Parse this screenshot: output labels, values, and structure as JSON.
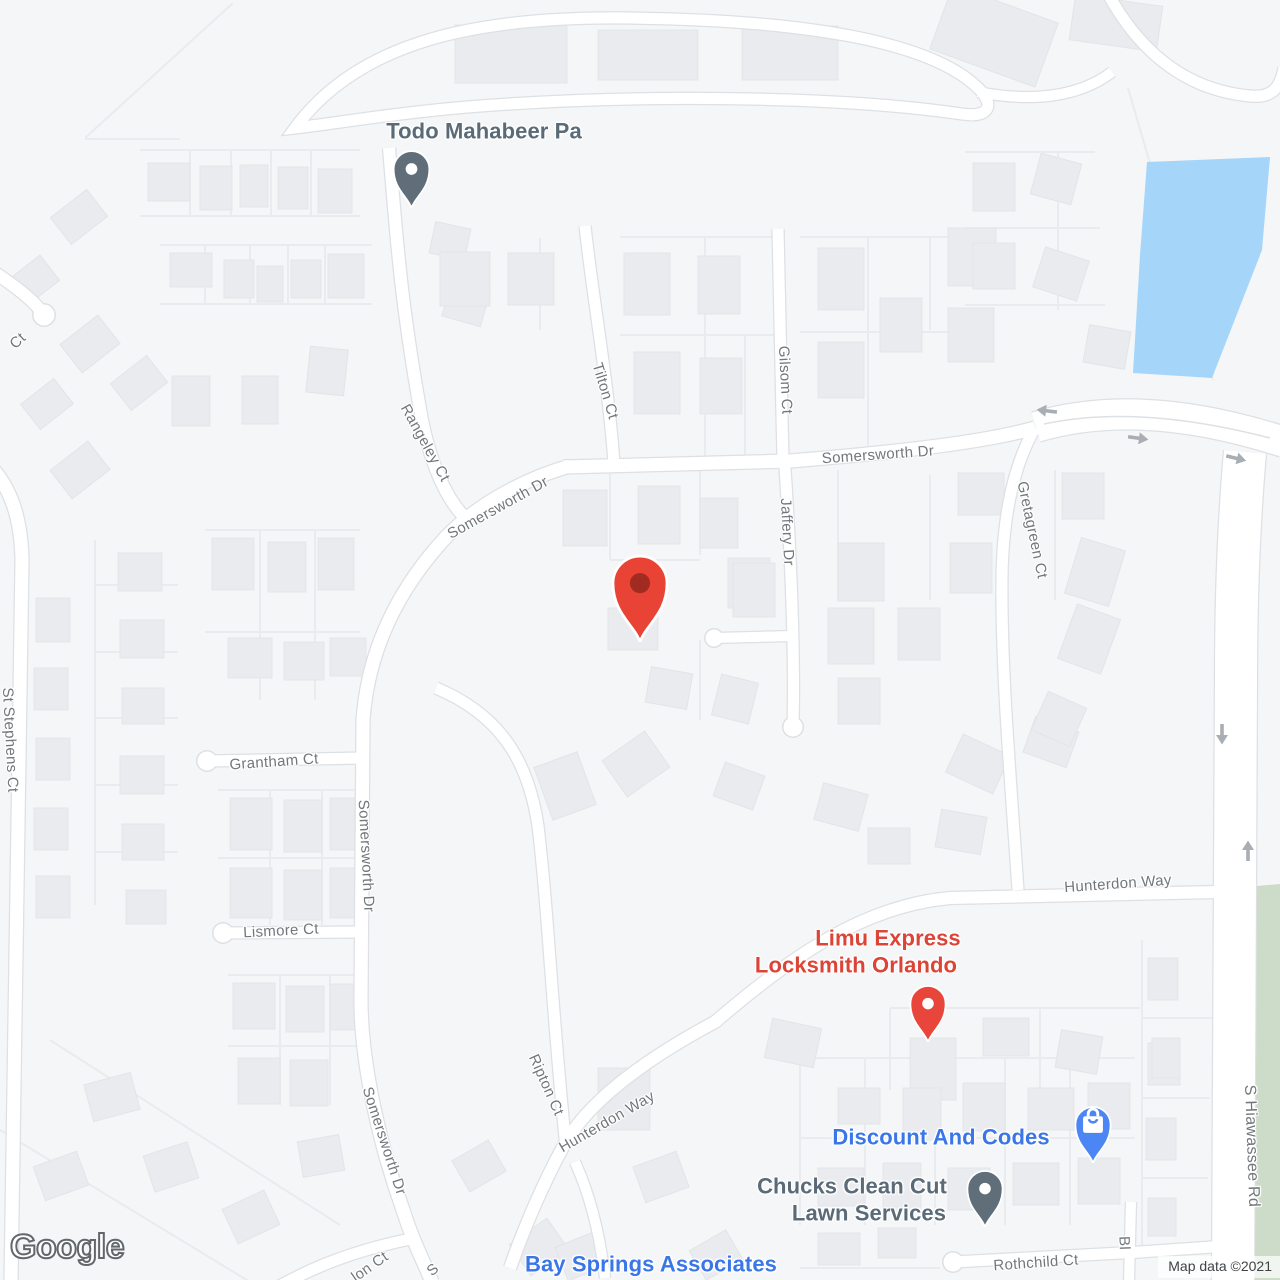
{
  "map": {
    "provider_logo": "Google",
    "attribution": "Map data ©2021",
    "colors": {
      "land": "#f5f6f7",
      "road_fill": "#ffffff",
      "road_casing": "#dde0e4",
      "parcel_line": "#e9ebee",
      "building_fill": "#e9ebee",
      "building_stroke": "#e2e5e8",
      "water": "#a6d5fa",
      "park_green": "#ccdcc8",
      "street_label": "#72777b",
      "poi_dark": "#5a6b77",
      "poi_red": "#dc4437",
      "poi_blue": "#3a76e8",
      "pin_gray": "#5f6e79",
      "pin_red": "#e84335",
      "pin_red_inner": "#a12b21",
      "pin_blue": "#4c86f4",
      "arrow": "#a9aeb4"
    },
    "labels": [
      {
        "text": "Todo Mahabeer Pa",
        "kind": "poi dark",
        "x": 484,
        "y": 131,
        "rot": 0,
        "size": 22
      },
      {
        "text": "Tilton Ct",
        "kind": "street",
        "x": 605,
        "y": 391,
        "rot": 73,
        "size": 15
      },
      {
        "text": "Gilsom Ct",
        "kind": "street",
        "x": 785,
        "y": 380,
        "rot": 87,
        "size": 15
      },
      {
        "text": "Somersworth Dr",
        "kind": "street",
        "x": 878,
        "y": 455,
        "rot": -4,
        "size": 15
      },
      {
        "text": "Jaffery Dr",
        "kind": "street",
        "x": 787,
        "y": 532,
        "rot": 87,
        "size": 15
      },
      {
        "text": "Gretagreen Ct",
        "kind": "street",
        "x": 1032,
        "y": 530,
        "rot": 78,
        "size": 15
      },
      {
        "text": "Rangeley Ct",
        "kind": "street",
        "x": 425,
        "y": 443,
        "rot": 61,
        "size": 15
      },
      {
        "text": "Somersworth Dr",
        "kind": "street",
        "x": 498,
        "y": 508,
        "rot": -29,
        "size": 15
      },
      {
        "text": "Grantham Ct",
        "kind": "street",
        "x": 274,
        "y": 762,
        "rot": -4,
        "size": 15
      },
      {
        "text": "Somersworth Dr",
        "kind": "street",
        "x": 366,
        "y": 856,
        "rot": 87,
        "size": 15
      },
      {
        "text": "Lismore Ct",
        "kind": "street",
        "x": 281,
        "y": 931,
        "rot": -3,
        "size": 15
      },
      {
        "text": "Somersworth Dr",
        "kind": "street",
        "x": 384,
        "y": 1141,
        "rot": 72,
        "size": 15
      },
      {
        "text": "Ripton Ct",
        "kind": "street",
        "x": 546,
        "y": 1085,
        "rot": 66,
        "size": 15
      },
      {
        "text": "Hunterdon Way",
        "kind": "street",
        "x": 607,
        "y": 1122,
        "rot": -30,
        "size": 15
      },
      {
        "text": "Hunterdon Way",
        "kind": "street",
        "x": 1118,
        "y": 884,
        "rot": -4,
        "size": 15
      },
      {
        "text": "S Hiawassee Rd",
        "kind": "street",
        "x": 1251,
        "y": 1146,
        "rot": 88,
        "size": 16
      },
      {
        "text": "St Stephens Ct",
        "kind": "street",
        "x": 10,
        "y": 740,
        "rot": 87,
        "size": 15
      },
      {
        "text": "Rothchild Ct",
        "kind": "street",
        "x": 1036,
        "y": 1263,
        "rot": -4,
        "size": 15
      },
      {
        "text": "Ct",
        "kind": "street",
        "x": 18,
        "y": 341,
        "rot": -42,
        "size": 15
      },
      {
        "text": "lon Ct",
        "kind": "street",
        "x": 370,
        "y": 1267,
        "rot": -35,
        "size": 15
      },
      {
        "text": "S",
        "kind": "street",
        "x": 433,
        "y": 1270,
        "rot": -40,
        "size": 15
      },
      {
        "text": "Bl",
        "kind": "street",
        "x": 1124,
        "y": 1243,
        "rot": 88,
        "size": 15
      },
      {
        "text": "Limu Express",
        "kind": "poi red",
        "x": 888,
        "y": 938,
        "rot": 0,
        "size": 22
      },
      {
        "text": "Locksmith Orlando",
        "kind": "poi red",
        "x": 856,
        "y": 965,
        "rot": 0,
        "size": 22
      },
      {
        "text": "Discount And Codes",
        "kind": "poi blue",
        "x": 941,
        "y": 1137,
        "rot": 0,
        "size": 22
      },
      {
        "text": "Chucks Clean Cut",
        "kind": "poi dark",
        "x": 852,
        "y": 1186,
        "rot": 0,
        "size": 22
      },
      {
        "text": "Lawn Services",
        "kind": "poi dark",
        "x": 869,
        "y": 1213,
        "rot": 0,
        "size": 22
      },
      {
        "text": "Bay Springs Associates",
        "kind": "poi blue",
        "x": 651,
        "y": 1264,
        "rot": 0,
        "size": 22
      }
    ],
    "pins": [
      {
        "name": "todo-mahabeer-pin",
        "icon": "balloon-pin-icon",
        "style": "balloon",
        "color": "#5f6e79",
        "x": 411,
        "y": 208,
        "s": 1.62
      },
      {
        "name": "destination-marker",
        "icon": "map-marker-icon",
        "style": "marker",
        "color": "#e84335",
        "inner": "#a12b21",
        "x": 640,
        "y": 642,
        "s": 2.45
      },
      {
        "name": "limu-express-locksmith-pin",
        "icon": "balloon-pin-icon",
        "style": "balloon",
        "color": "#e8463b",
        "x": 928,
        "y": 1042,
        "s": 1.6
      },
      {
        "name": "discount-and-codes-pin",
        "icon": "shopping-bag-pin-icon",
        "style": "shopping",
        "color": "#4c86f4",
        "x": 1093,
        "y": 1163,
        "s": 1.58
      },
      {
        "name": "chucks-lawn-services-pin",
        "icon": "balloon-pin-icon",
        "style": "balloon",
        "color": "#5f6e79",
        "x": 985,
        "y": 1227,
        "s": 1.6
      }
    ],
    "arrows": [
      {
        "name": "oneway-arrow-west",
        "x": 1048,
        "y": 411,
        "rot": 187
      },
      {
        "name": "oneway-arrow-east",
        "x": 1137,
        "y": 438,
        "rot": 8
      },
      {
        "name": "oneway-arrow-east",
        "x": 1235,
        "y": 458,
        "rot": 14
      },
      {
        "name": "oneway-arrow-south",
        "x": 1222,
        "y": 733,
        "rot": 90
      },
      {
        "name": "oneway-arrow-north",
        "x": 1248,
        "y": 852,
        "rot": -90
      }
    ]
  }
}
